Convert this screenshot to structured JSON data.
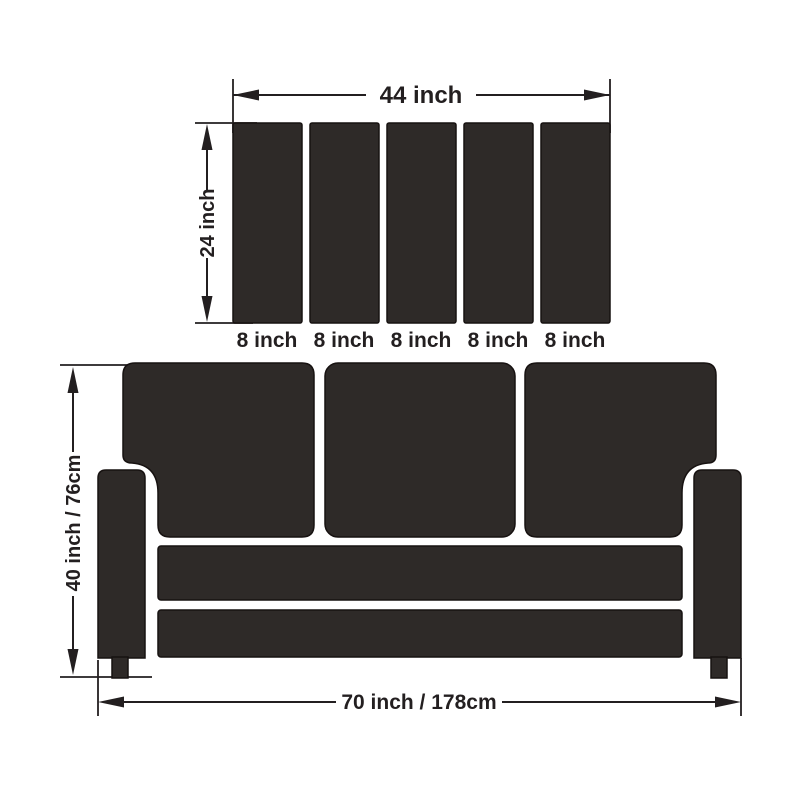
{
  "colors": {
    "shape_fill": "#2e2a28",
    "line_color": "#231f20",
    "background": "#ffffff"
  },
  "top_assembly": {
    "width_label": "44 inch",
    "height_label": "24 inch",
    "panel_labels": [
      "8 inch",
      "8 inch",
      "8 inch",
      "8 inch",
      "8 inch"
    ]
  },
  "sofa": {
    "height_label": "40 inch / 76cm",
    "width_label": "70 inch / 178cm"
  }
}
